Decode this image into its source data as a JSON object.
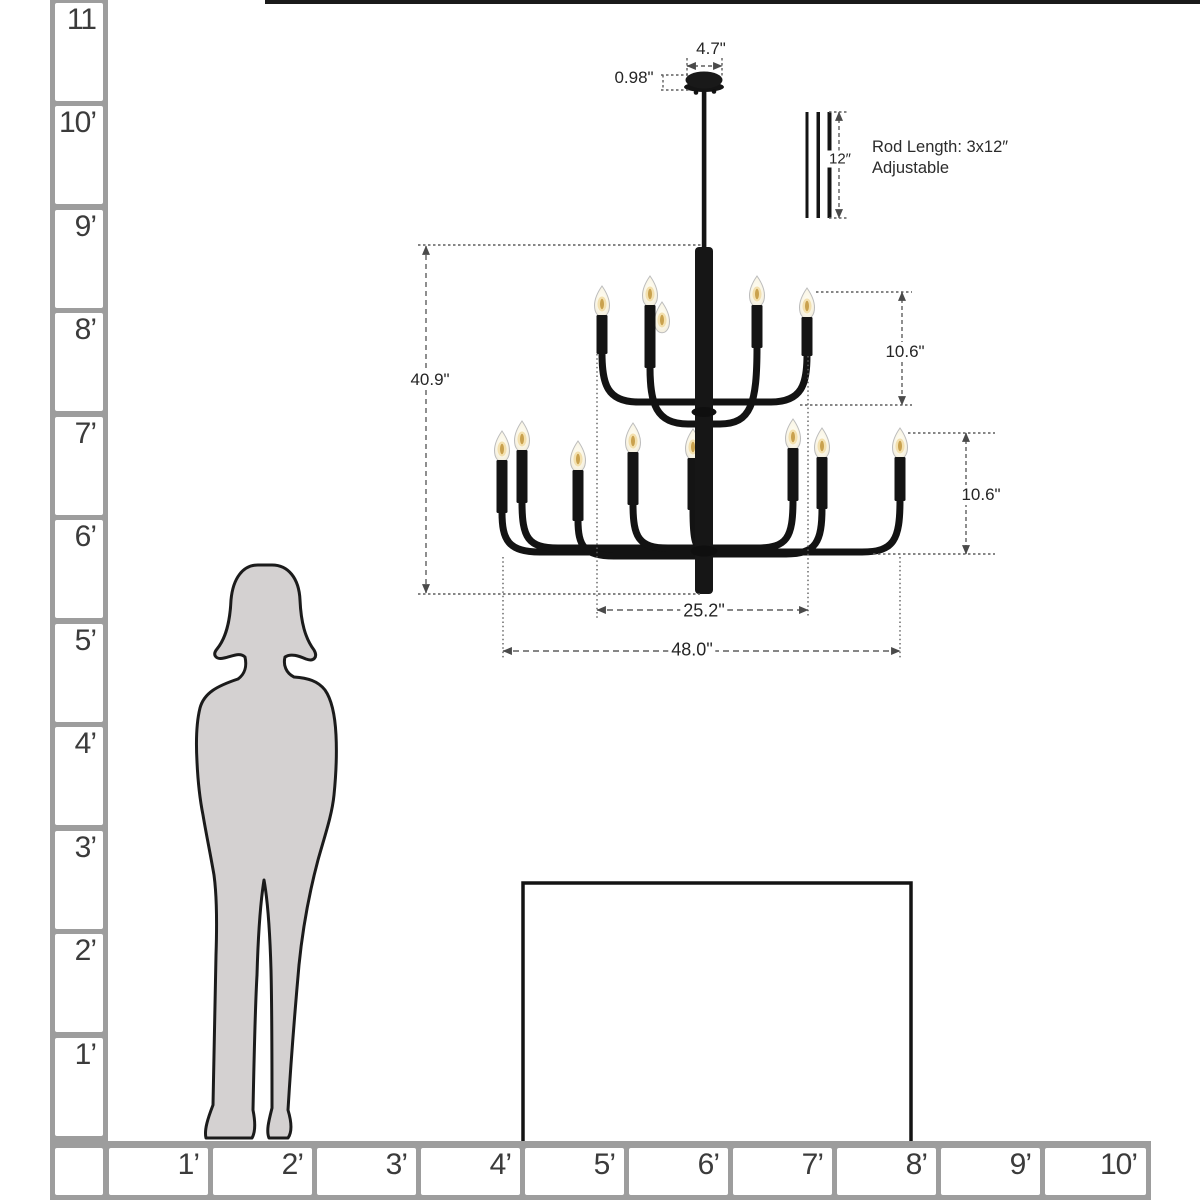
{
  "scale_ruler": {
    "vertical_labels": [
      "11",
      "10’",
      "9’",
      "8’",
      "7’",
      "6’",
      "5’",
      "4’",
      "3’",
      "2’",
      "1’"
    ],
    "horizontal_labels": [
      "1’",
      "2’",
      "3’",
      "4’",
      "5’",
      "6’",
      "7’",
      "8’",
      "9’",
      "10’"
    ]
  },
  "chandelier": {
    "dimensions": {
      "canopy_width": "4.7\"",
      "canopy_height": "0.98\"",
      "rod_segment_length": "12″",
      "overall_height": "40.9\"",
      "upper_tier_height": "10.6\"",
      "lower_tier_height": "10.6\"",
      "upper_tier_width": "25.2\"",
      "overall_width": "48.0\""
    },
    "rod_note_line1": "Rod Length: 3x12″",
    "rod_note_line2": "Adjustable",
    "visible_lights_upper_tier": 4,
    "visible_lights_lower_tier": 8
  },
  "colors": {
    "fixture_black": "#141414",
    "ruler_gray": "#9d9d9d",
    "silhouette_gray": "#d4d1d1",
    "dimension_line": "#5f5f5f"
  }
}
